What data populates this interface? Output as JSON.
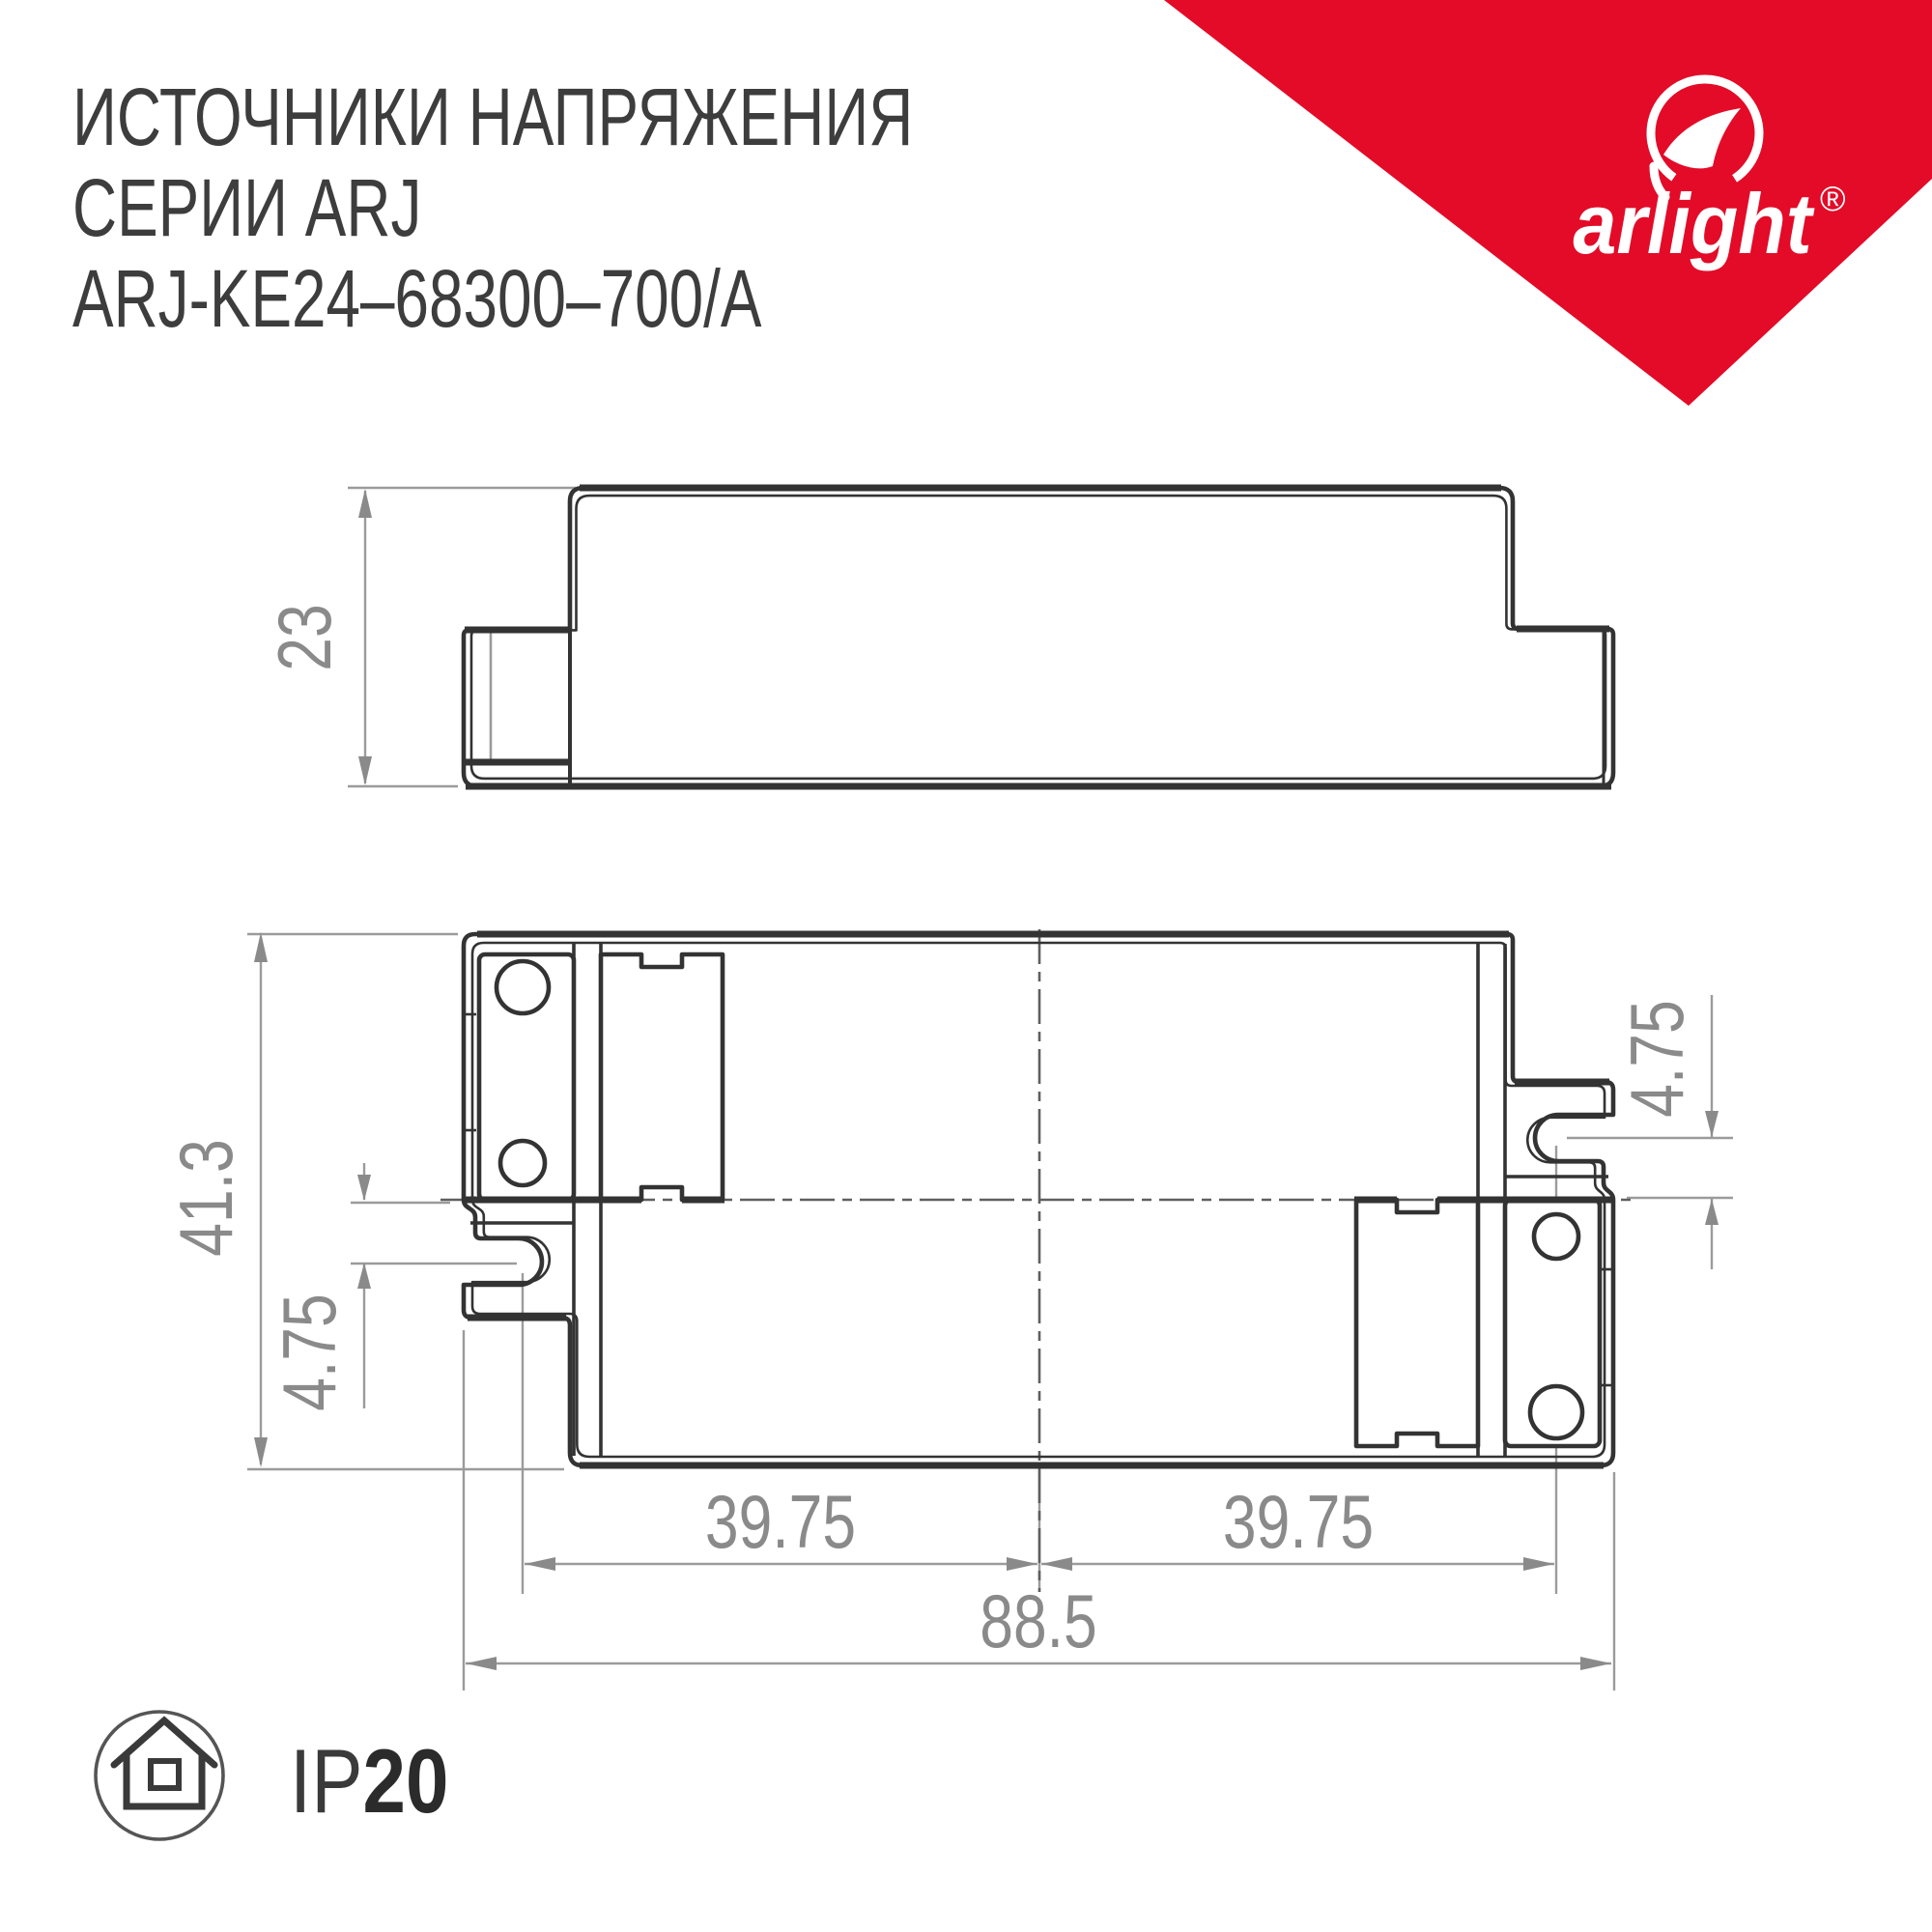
{
  "title": {
    "line1": "ИСТОЧНИКИ НАПРЯЖЕНИЯ",
    "line2": "СЕРИИ ARJ",
    "line3": "ARJ-KE24–68300–700/A"
  },
  "brand": {
    "name": "arlight",
    "registered": "®",
    "red": "#e30b28"
  },
  "ip_badge": {
    "prefix": "IP",
    "value": "20",
    "icon": "house-in-circle-icon"
  },
  "drawing": {
    "units": "mm",
    "side_view": {
      "height": "23"
    },
    "plan_view": {
      "height": "41.3",
      "slot_offset_left": "4.75",
      "slot_offset_right": "4.75",
      "slot_pitch_left": "39.75",
      "slot_pitch_right": "39.75",
      "overall_width": "88.5"
    }
  }
}
